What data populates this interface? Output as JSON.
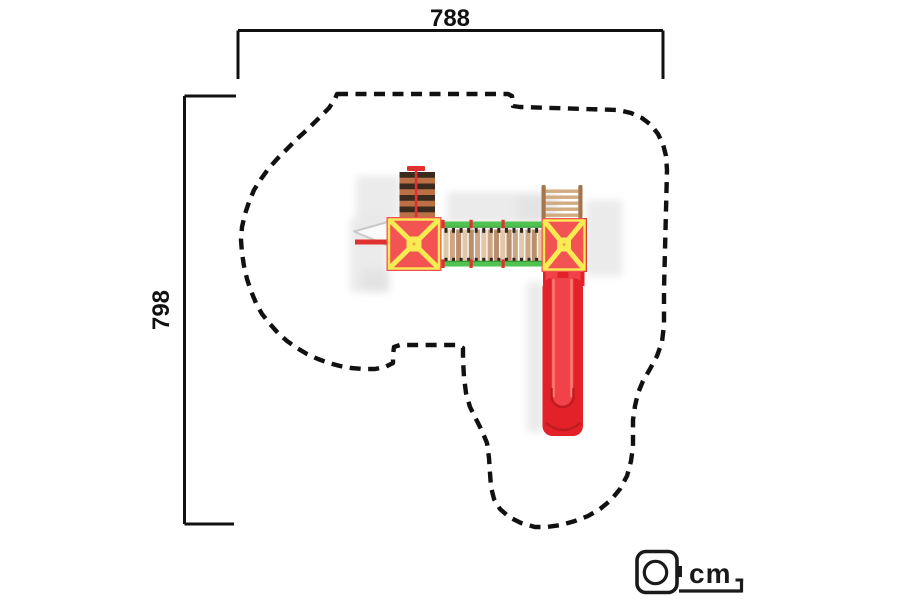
{
  "dimension_labels": {
    "width": "788",
    "height": "798"
  },
  "unit_indicator": {
    "icon": "tape-measure-icon",
    "label": "cm"
  },
  "colors": {
    "line": "#111111",
    "shadow": "#dedede",
    "roof_red": "#f45353",
    "roof_red_dark": "#d63e3e",
    "roof_yellow": "#f8ec52",
    "slide_red": "#e22228",
    "slide_red_light": "#f04248",
    "slide_red_dark": "#bf1c22",
    "slide_highlight": "#ff7d75",
    "rail_green": "#4fc24f",
    "rail_green_dark": "#2f8f2f",
    "plank_light": "#e3c7a9",
    "plank_mid": "#cda686",
    "plank_dark": "#b98f6d",
    "baluster": "#33271c",
    "climb_dark": "#3b2b1f",
    "climb_orange": "#bd7046",
    "rope_red": "#e03030",
    "ladder_wood": "#a3754f",
    "ladder_rung": "#d2ab81",
    "grab_gray": "#c9c9c9"
  },
  "safety_zone": {
    "outline_points": [
      [
        337,
        94
      ],
      [
        508,
        94
      ],
      [
        512,
        96
      ],
      [
        513,
        106
      ],
      [
        520,
        107
      ],
      [
        618,
        110
      ],
      [
        631,
        113
      ],
      [
        642,
        118
      ],
      [
        651,
        125
      ],
      [
        658,
        134
      ],
      [
        663,
        144
      ],
      [
        666,
        156
      ],
      [
        667,
        170
      ],
      [
        666,
        210
      ],
      [
        665,
        250
      ],
      [
        664,
        290
      ],
      [
        664,
        325
      ],
      [
        662,
        342
      ],
      [
        657,
        356
      ],
      [
        650,
        369
      ],
      [
        643,
        381
      ],
      [
        638,
        393
      ],
      [
        635,
        406
      ],
      [
        633,
        420
      ],
      [
        633,
        434
      ],
      [
        633,
        447
      ],
      [
        631,
        461
      ],
      [
        627,
        476
      ],
      [
        620,
        489
      ],
      [
        611,
        500
      ],
      [
        600,
        509
      ],
      [
        588,
        516
      ],
      [
        575,
        521
      ],
      [
        561,
        525
      ],
      [
        547,
        527
      ],
      [
        535,
        527
      ],
      [
        521,
        523
      ],
      [
        509,
        517
      ],
      [
        500,
        509
      ],
      [
        494,
        499
      ],
      [
        491,
        487
      ],
      [
        490,
        473
      ],
      [
        489,
        458
      ],
      [
        487,
        443
      ],
      [
        482,
        431
      ],
      [
        476,
        419
      ],
      [
        470,
        407
      ],
      [
        466,
        393
      ],
      [
        464,
        377
      ],
      [
        463,
        360
      ],
      [
        463,
        348
      ],
      [
        458,
        345
      ],
      [
        400,
        345
      ],
      [
        394,
        347
      ],
      [
        393,
        355
      ],
      [
        393,
        363
      ],
      [
        385,
        367
      ],
      [
        375,
        369
      ],
      [
        363,
        369
      ],
      [
        351,
        368
      ],
      [
        340,
        366
      ],
      [
        329,
        363
      ],
      [
        318,
        359
      ],
      [
        307,
        354
      ],
      [
        297,
        348
      ],
      [
        287,
        341
      ],
      [
        278,
        333
      ],
      [
        270,
        324
      ],
      [
        262,
        314
      ],
      [
        256,
        303
      ],
      [
        251,
        291
      ],
      [
        247,
        279
      ],
      [
        244,
        266
      ],
      [
        242,
        253
      ],
      [
        241,
        240
      ],
      [
        242,
        227
      ],
      [
        245,
        214
      ],
      [
        249,
        202
      ],
      [
        254,
        190
      ],
      [
        261,
        179
      ],
      [
        269,
        168
      ],
      [
        278,
        158
      ],
      [
        288,
        148
      ],
      [
        298,
        138
      ],
      [
        309,
        128
      ],
      [
        319,
        118
      ],
      [
        329,
        108
      ],
      [
        335,
        99
      ]
    ]
  },
  "equipment_parts": [
    "climbing-wall",
    "left-tower-roof",
    "bridge",
    "right-tower-roof",
    "ladder",
    "slide",
    "grab-bar"
  ]
}
